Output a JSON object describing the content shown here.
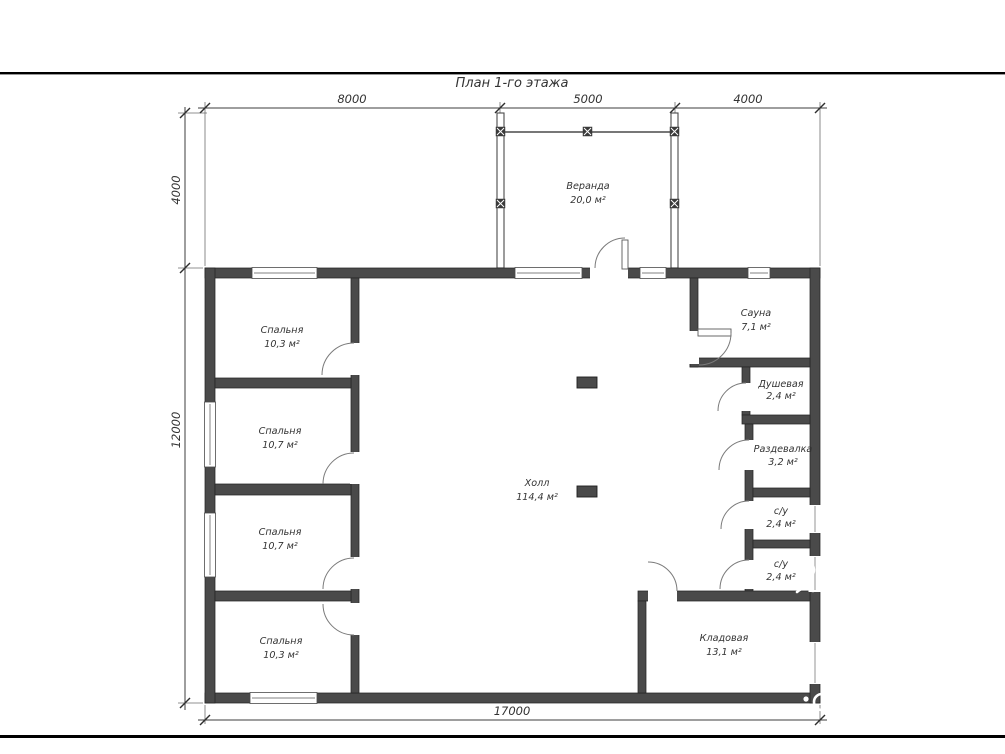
{
  "title": "План 1-го этажа",
  "dims": {
    "top": [
      "8000",
      "5000",
      "4000"
    ],
    "left": [
      "4000",
      "12000"
    ],
    "bottom": [
      "17000"
    ]
  },
  "rooms": {
    "veranda": {
      "name": "Веранда",
      "area": "20,0 м²"
    },
    "bedroom1": {
      "name": "Спальня",
      "area": "10,3 м²"
    },
    "bedroom2": {
      "name": "Спальня",
      "area": "10,7 м²"
    },
    "bedroom3": {
      "name": "Спальня",
      "area": "10,7 м²"
    },
    "bedroom4": {
      "name": "Спальня",
      "area": "10,3 м²"
    },
    "hall": {
      "name": "Холл",
      "area": "114,4 м²"
    },
    "sauna": {
      "name": "Сауна",
      "area": "7,1 м²"
    },
    "shower": {
      "name": "Душевая",
      "area": "2,4 м²"
    },
    "dressing": {
      "name": "Раздевалка",
      "area": "3,2 м²"
    },
    "wc1": {
      "name": "с/у",
      "area": "2,4 м²"
    },
    "wc2": {
      "name": "с/у",
      "area": "2,4 м²"
    },
    "storage": {
      "name": "Кладовая",
      "area": "13,1 м²"
    }
  },
  "colors": {
    "wall": "#4a4a4a",
    "line": "#3c3c3c",
    "text": "#333333"
  }
}
